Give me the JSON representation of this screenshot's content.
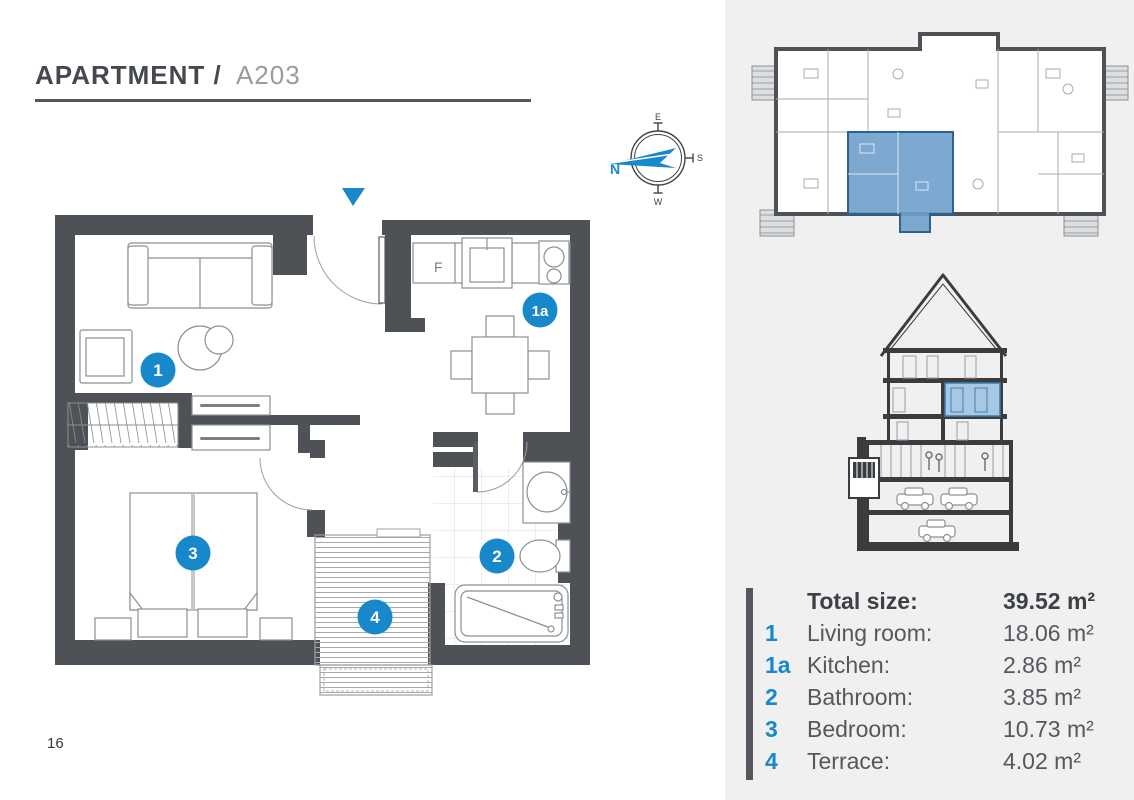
{
  "header": {
    "title_bold": "APARTMENT /",
    "title_unit": "A203"
  },
  "page_number": "16",
  "compass": {
    "n": "N",
    "e": "E",
    "s": "S",
    "w": "W"
  },
  "floor_plan": {
    "fridge_label": "F",
    "badges": {
      "living_room": "1",
      "kitchen": "1a",
      "bathroom": "2",
      "bedroom": "3",
      "terrace": "4"
    }
  },
  "legend": {
    "header": {
      "label": "Total size:",
      "value": "39.52 m²"
    },
    "rows": [
      {
        "num": "1",
        "label": "Living room:",
        "value": "18.06 m²"
      },
      {
        "num": "1a",
        "label": "Kitchen:",
        "value": "2.86 m²"
      },
      {
        "num": "2",
        "label": "Bathroom:",
        "value": "3.85 m²"
      },
      {
        "num": "3",
        "label": "Bedroom:",
        "value": "10.73 m²"
      },
      {
        "num": "4",
        "label": "Terrace:",
        "value": "4.02 m²"
      }
    ]
  },
  "colors": {
    "accent": "#1788C9",
    "wall": "#4E5256",
    "panel_bg": "#F0F0F1",
    "unit_highlight": "#6FA0CC",
    "text": "#54585C"
  }
}
